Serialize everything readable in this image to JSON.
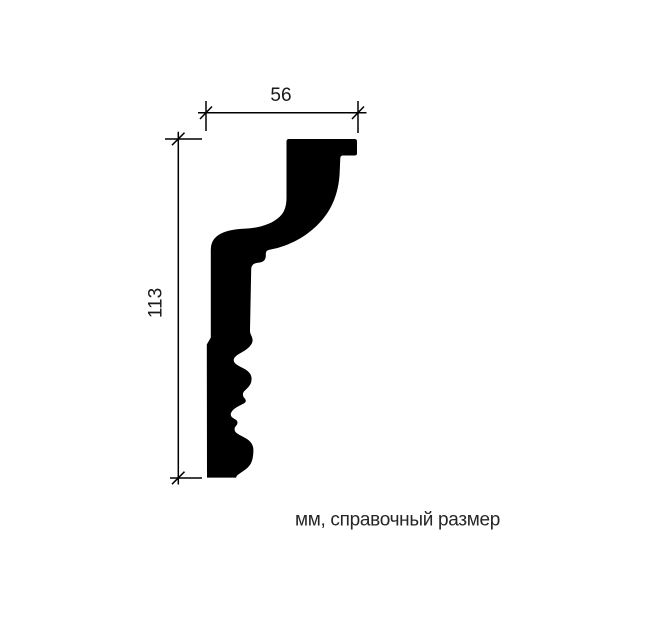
{
  "page": {
    "background": "#ffffff"
  },
  "drawing": {
    "kind": "molding-profile-cross-section",
    "ink": "#000000",
    "profile_fill": "#000000"
  },
  "dimensions": {
    "width": {
      "value": "56"
    },
    "height": {
      "value": "113"
    }
  },
  "caption": {
    "text": "мм, справочный размер",
    "color": "#262626"
  }
}
